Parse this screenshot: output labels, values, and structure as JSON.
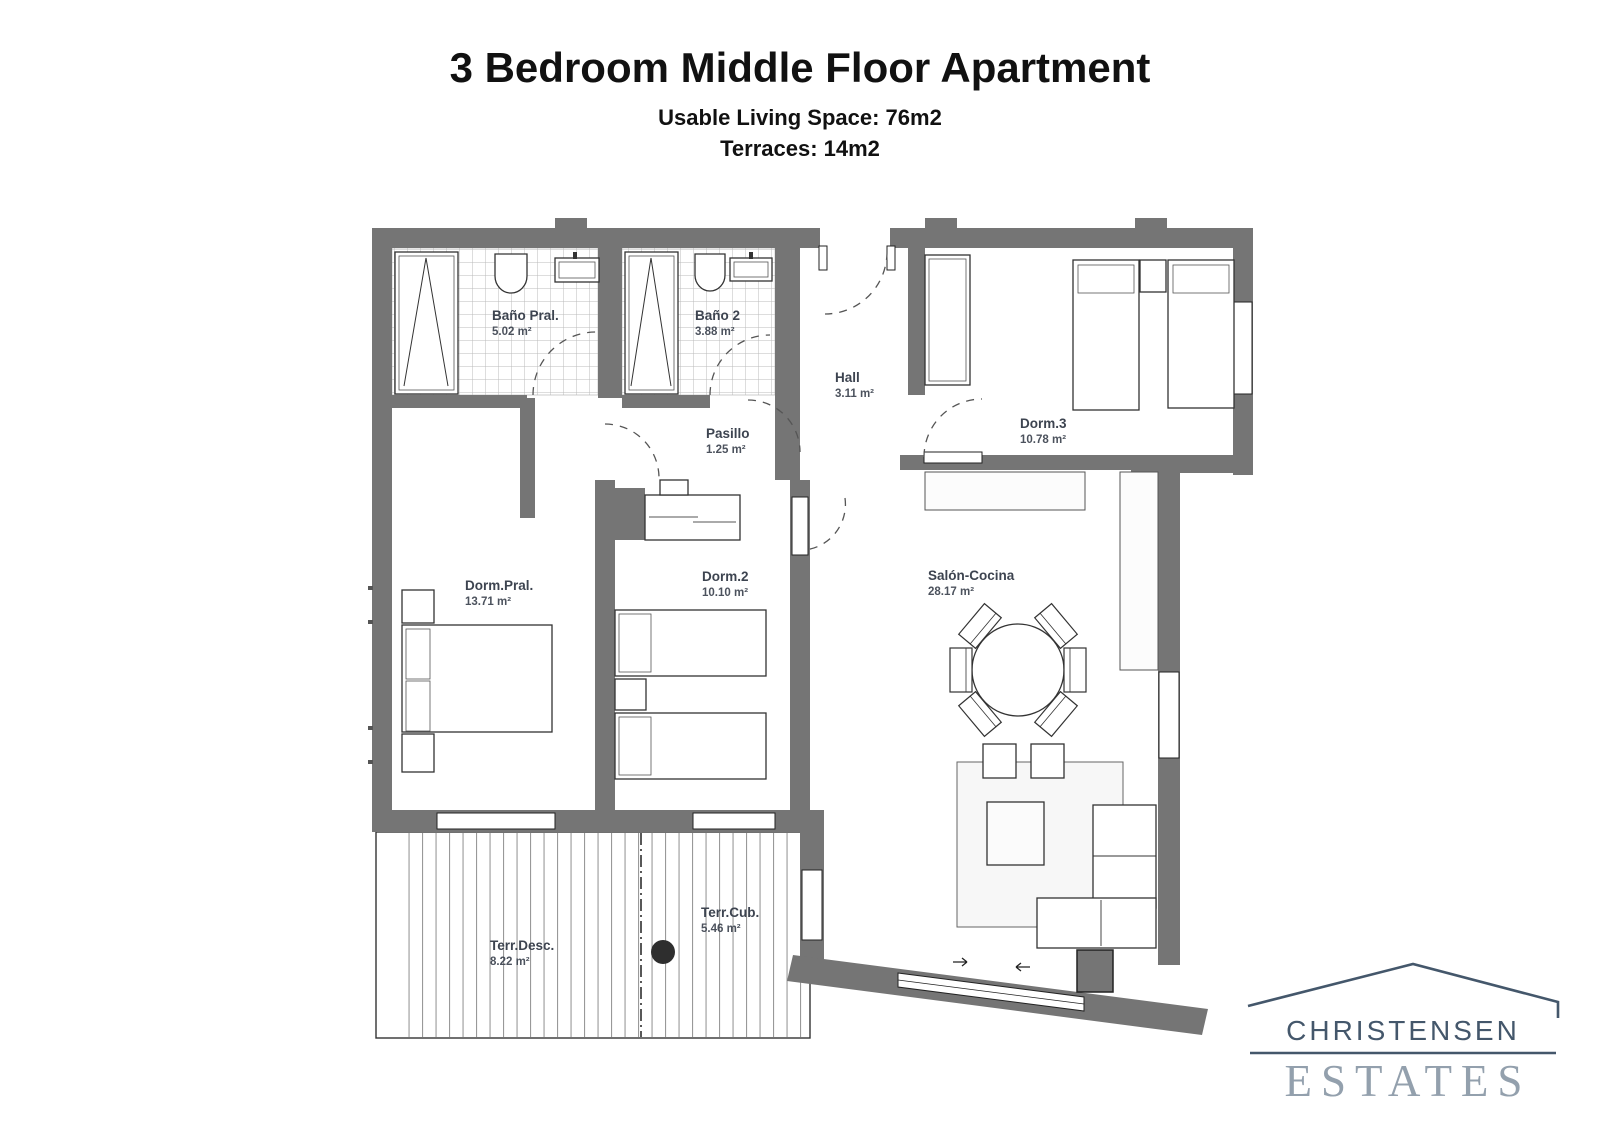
{
  "header": {
    "title": "3 Bedroom Middle Floor Apartment",
    "subtitle_line1": "Usable Living Space: 76m2",
    "subtitle_line2": "Terraces: 14m2"
  },
  "rooms": [
    {
      "id": "bano-pral",
      "name": "Baño Pral.",
      "area": "5.02 m²"
    },
    {
      "id": "bano-2",
      "name": "Baño 2",
      "area": "3.88 m²"
    },
    {
      "id": "hall",
      "name": "Hall",
      "area": "3.11 m²"
    },
    {
      "id": "pasillo",
      "name": "Pasillo",
      "area": "1.25 m²"
    },
    {
      "id": "dorm-3",
      "name": "Dorm.3",
      "area": "10.78 m²"
    },
    {
      "id": "dorm-pral",
      "name": "Dorm.Pral.",
      "area": "13.71 m²"
    },
    {
      "id": "dorm-2",
      "name": "Dorm.2",
      "area": "10.10 m²"
    },
    {
      "id": "salon",
      "name": "Salón-Cocina",
      "area": "28.17 m²"
    },
    {
      "id": "terr-desc",
      "name": "Terr.Desc.",
      "area": "8.22 m²"
    },
    {
      "id": "terr-cub",
      "name": "Terr.Cub.",
      "area": "5.46 m²"
    }
  ],
  "logo": {
    "name_top": "CHRISTENSEN",
    "name_bottom": "ESTATES"
  },
  "colors": {
    "wall": "#757575",
    "room_label": "#3d4450",
    "logo_primary": "#44576b",
    "logo_secondary": "#93a0ad",
    "tile_line": "#bbbbbb",
    "deck_line": "#999999"
  }
}
